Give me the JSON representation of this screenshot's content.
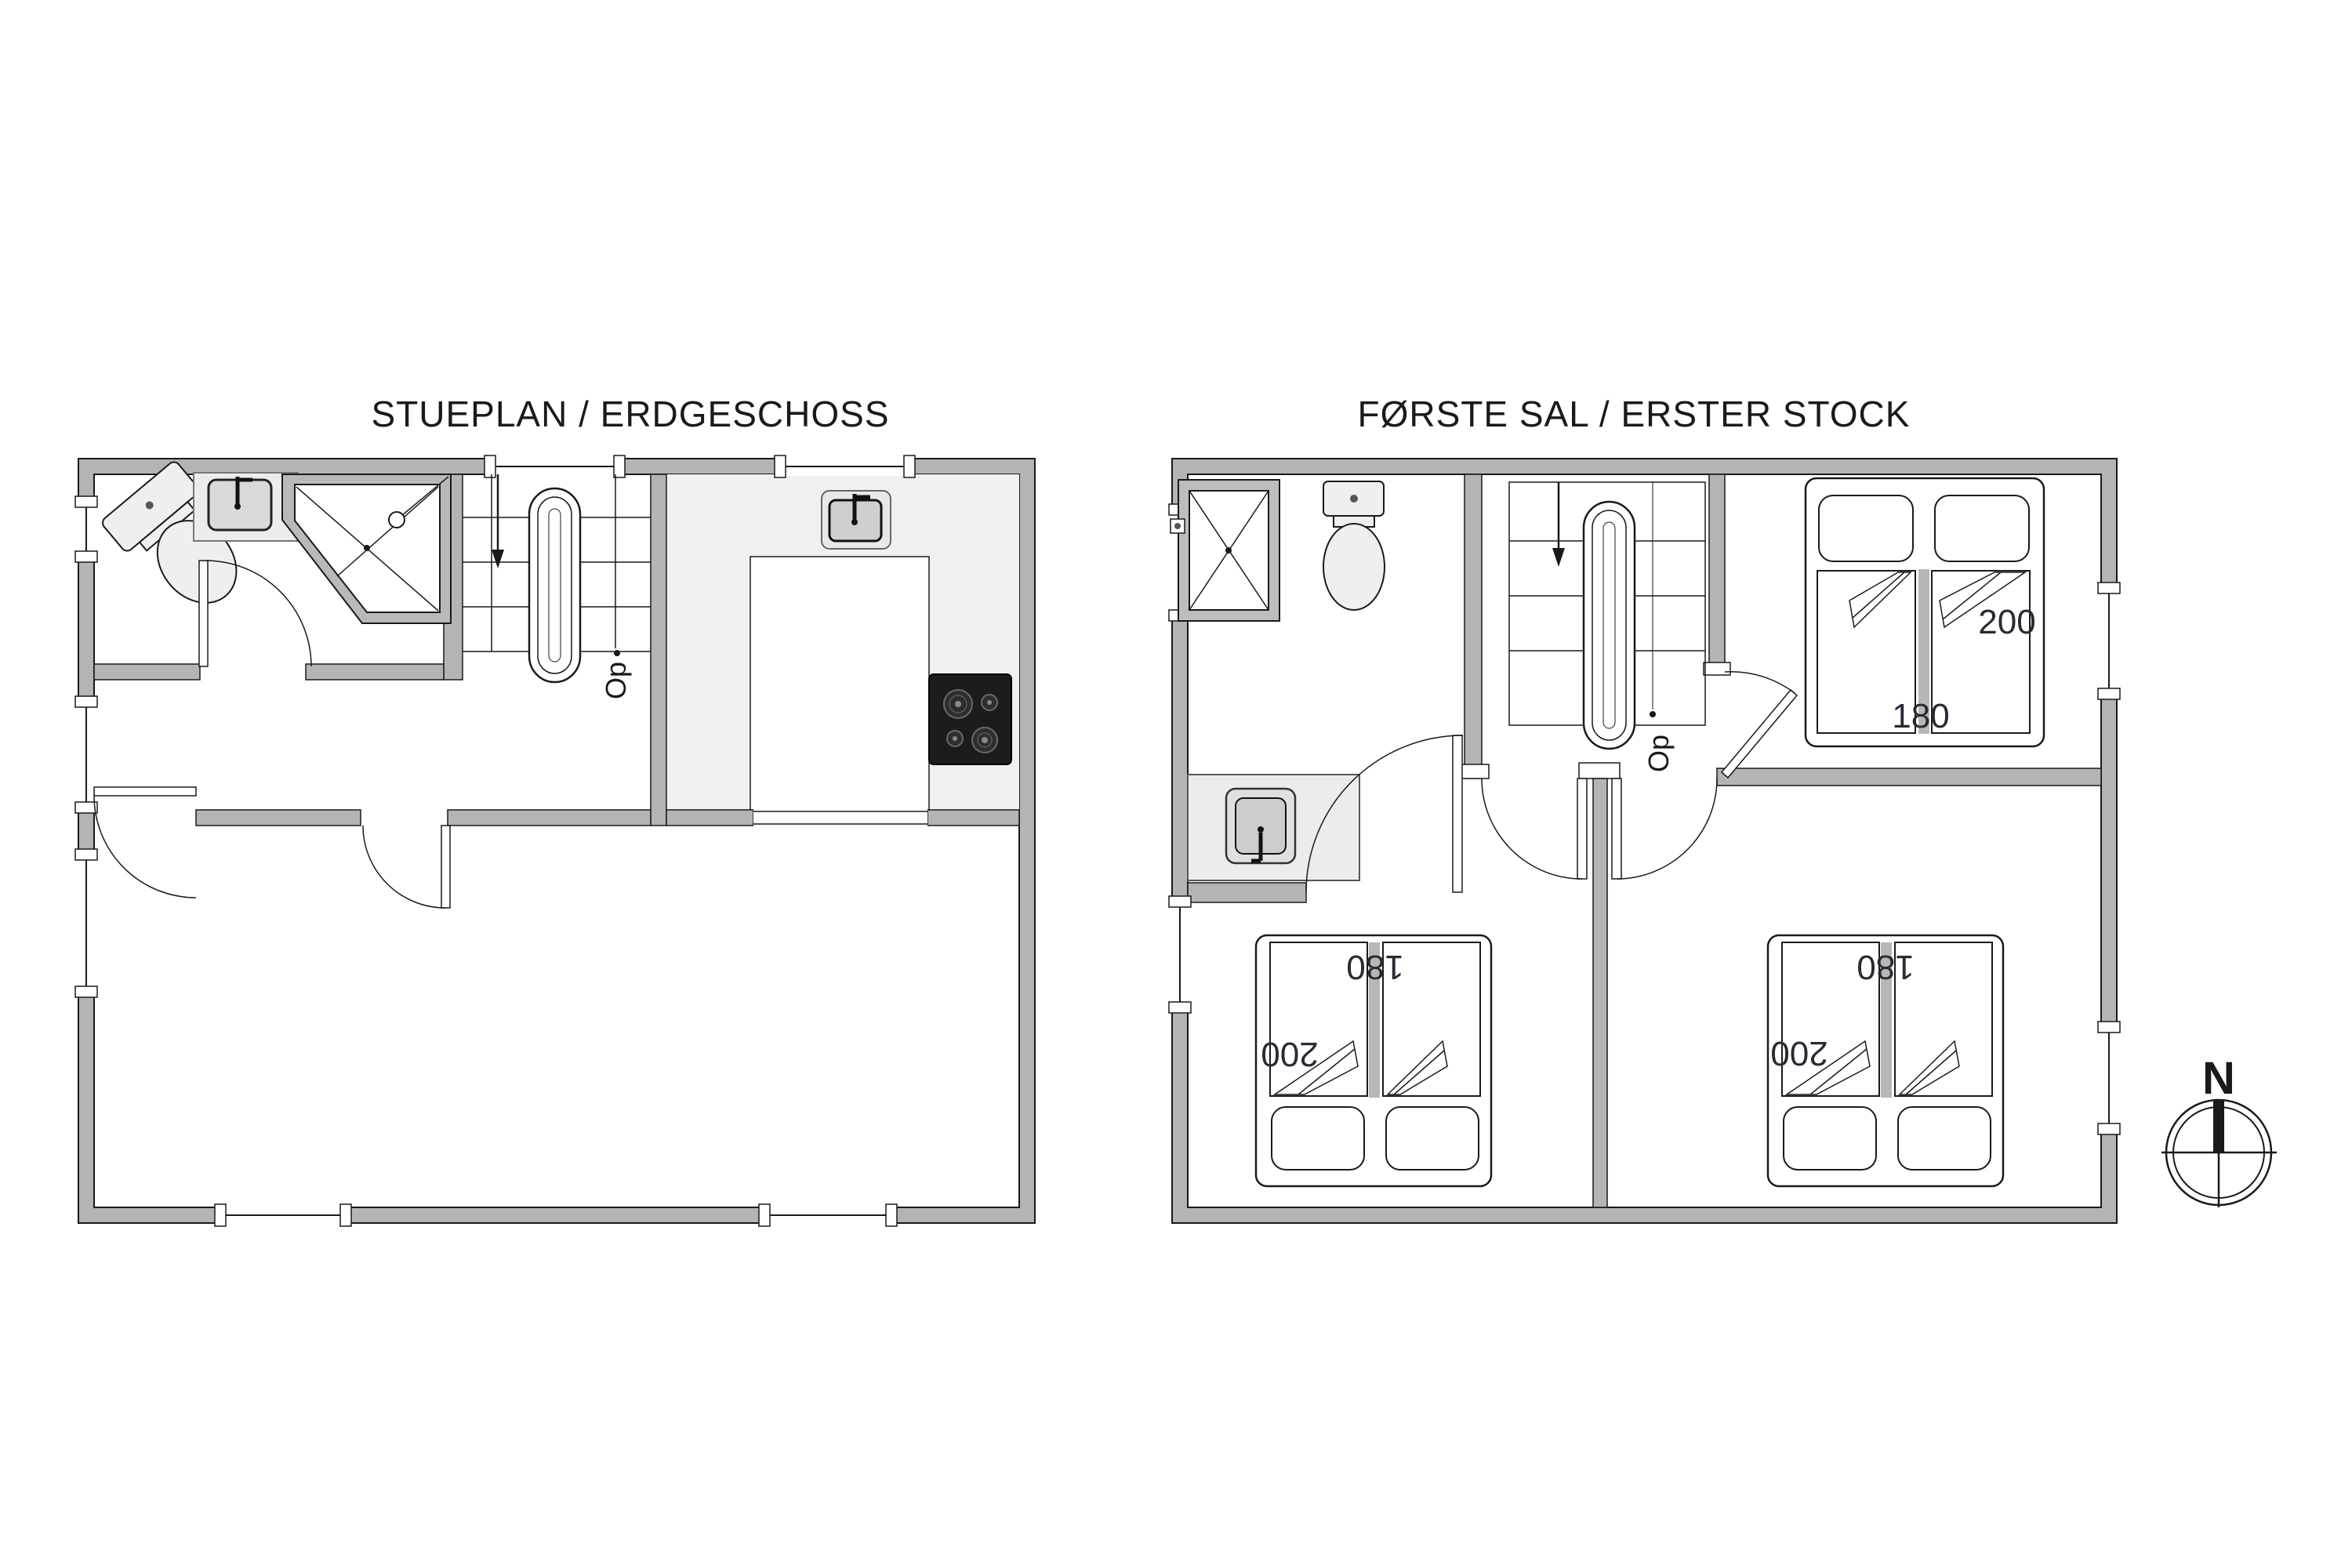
{
  "floorplans": {
    "ground": {
      "title": "STUEPLAN / ERDGESCHOSS",
      "stairs_label": "Op"
    },
    "first": {
      "title": "FØRSTE SAL / ERSTER STOCK",
      "stairs_label": "Op",
      "beds": {
        "double_top": {
          "length": "200",
          "width": "180"
        },
        "double_bottom_left": {
          "length": "200",
          "width": "180"
        },
        "double_bottom_right": {
          "length": "200",
          "width": "180"
        }
      }
    }
  },
  "compass": {
    "north_label": "N"
  },
  "colors": {
    "wall": "#b4b4b4",
    "outline": "#1a1a1a",
    "kitchen_floor": "#f0f0f0",
    "fixture_fill": "#efefef",
    "stove": "#1c1c1c",
    "dimension_text": "#2a2a35",
    "background": "#ffffff"
  }
}
